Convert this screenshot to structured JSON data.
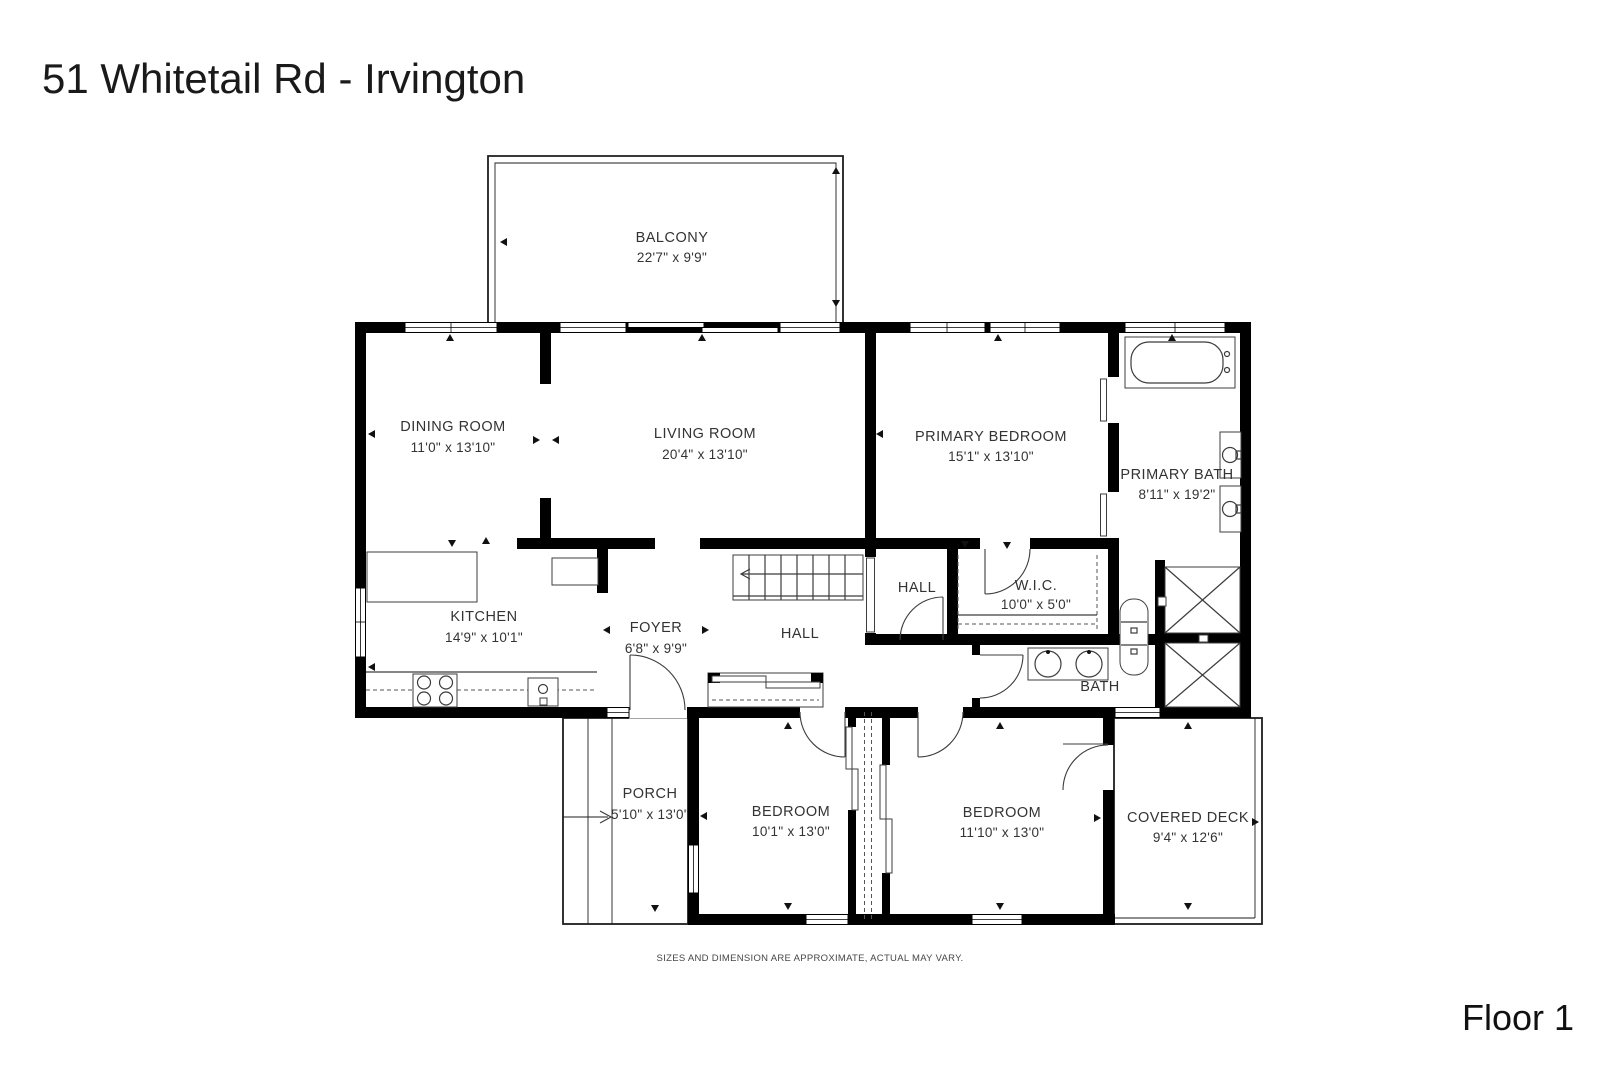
{
  "title": "51 Whitetail Rd - Irvington",
  "floor_label": "Floor 1",
  "disclaimer": "SIZES AND DIMENSION ARE APPROXIMATE, ACTUAL MAY VARY.",
  "rooms": {
    "balcony": {
      "name": "BALCONY",
      "dims": "22'7\" x 9'9\""
    },
    "dining": {
      "name": "DINING ROOM",
      "dims": "11'0\" x 13'10\""
    },
    "living": {
      "name": "LIVING ROOM",
      "dims": "20'4\" x 13'10\""
    },
    "primary_bedroom": {
      "name": "PRIMARY BEDROOM",
      "dims": "15'1\" x 13'10\""
    },
    "primary_bath": {
      "name": "PRIMARY BATH",
      "dims": "8'11\" x 19'2\""
    },
    "kitchen": {
      "name": "KITCHEN",
      "dims": "14'9\" x 10'1\""
    },
    "foyer": {
      "name": "FOYER",
      "dims": "6'8\" x 9'9\""
    },
    "hall": {
      "name": "HALL"
    },
    "hall_small": {
      "name": "HALL"
    },
    "wic": {
      "name": "W.I.C.",
      "dims": "10'0\" x 5'0\""
    },
    "bath": {
      "name": "BATH"
    },
    "bedroom1": {
      "name": "BEDROOM",
      "dims": "10'1\" x 13'0\""
    },
    "bedroom2": {
      "name": "BEDROOM",
      "dims": "11'10\" x 13'0\""
    },
    "porch": {
      "name": "PORCH",
      "dims": "5'10\" x 13'0\""
    },
    "covered_deck": {
      "name": "COVERED DECK",
      "dims": "9'4\" x 12'6\""
    }
  },
  "colors": {
    "walls": "#000000",
    "background": "#ffffff",
    "text": "#333333"
  }
}
